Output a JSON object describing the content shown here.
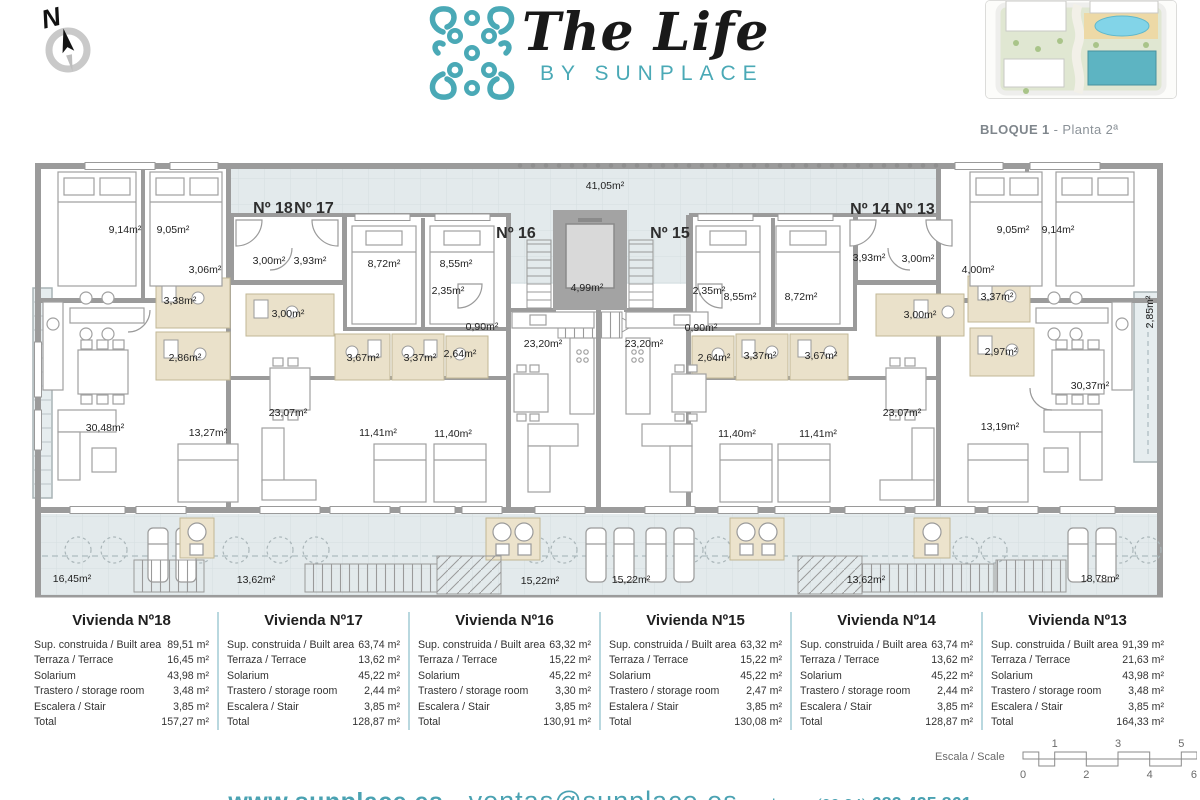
{
  "header": {
    "compass_letter": "N",
    "logo_title": "The Life",
    "logo_subtitle": "BY SUNPLACE",
    "siteplan_caption_bold": "BLOQUE 1",
    "siteplan_caption_rest": " - Planta 2ª"
  },
  "colors": {
    "brand_teal": "#4aa9b6",
    "wall_gray": "#9b9b9b",
    "terrace_fill": "#e3eaec",
    "bathroom_tan": "#eae1ca"
  },
  "plan": {
    "unit_labels": [
      {
        "t": "Nº 18",
        "x": 243,
        "y": 57
      },
      {
        "t": "Nº 17",
        "x": 284,
        "y": 57
      },
      {
        "t": "Nº 16",
        "x": 486,
        "y": 82
      },
      {
        "t": "Nº 15",
        "x": 640,
        "y": 82
      },
      {
        "t": "Nº 14",
        "x": 840,
        "y": 58
      },
      {
        "t": "Nº 13",
        "x": 885,
        "y": 58
      }
    ],
    "area_labels": [
      {
        "t": "41,05m²",
        "x": 575,
        "y": 34
      },
      {
        "t": "9,14m²",
        "x": 95,
        "y": 78
      },
      {
        "t": "9,05m²",
        "x": 143,
        "y": 78
      },
      {
        "t": "3,06m²",
        "x": 175,
        "y": 118
      },
      {
        "t": "3,00m²",
        "x": 239,
        "y": 109
      },
      {
        "t": "3,93m²",
        "x": 280,
        "y": 109
      },
      {
        "t": "8,72m²",
        "x": 354,
        "y": 112
      },
      {
        "t": "8,55m²",
        "x": 426,
        "y": 112
      },
      {
        "t": "2,35m²",
        "x": 418,
        "y": 139
      },
      {
        "t": "4,99m²",
        "x": 557,
        "y": 136
      },
      {
        "t": "2,35m²",
        "x": 679,
        "y": 139
      },
      {
        "t": "0,90m²",
        "x": 452,
        "y": 175
      },
      {
        "t": "0,90m²",
        "x": 671,
        "y": 176
      },
      {
        "t": "23,20m²",
        "x": 513,
        "y": 192
      },
      {
        "t": "23,20m²",
        "x": 614,
        "y": 192
      },
      {
        "t": "3,38m²",
        "x": 150,
        "y": 149
      },
      {
        "t": "3,00m²",
        "x": 258,
        "y": 162
      },
      {
        "t": "2,86m²",
        "x": 155,
        "y": 206
      },
      {
        "t": "3,67m²",
        "x": 333,
        "y": 206
      },
      {
        "t": "3,37m²",
        "x": 390,
        "y": 206
      },
      {
        "t": "2,64m²",
        "x": 430,
        "y": 202
      },
      {
        "t": "2,64m²",
        "x": 684,
        "y": 206
      },
      {
        "t": "3,37m²",
        "x": 730,
        "y": 204
      },
      {
        "t": "3,67m²",
        "x": 791,
        "y": 204
      },
      {
        "t": "8,55m²",
        "x": 710,
        "y": 145
      },
      {
        "t": "8,72m²",
        "x": 771,
        "y": 145
      },
      {
        "t": "3,93m²",
        "x": 839,
        "y": 106
      },
      {
        "t": "3,00m²",
        "x": 888,
        "y": 107
      },
      {
        "t": "3,00m²",
        "x": 890,
        "y": 163
      },
      {
        "t": "9,05m²",
        "x": 983,
        "y": 78
      },
      {
        "t": "9,14m²",
        "x": 1028,
        "y": 78
      },
      {
        "t": "4,00m²",
        "x": 948,
        "y": 118
      },
      {
        "t": "3,37m²",
        "x": 967,
        "y": 145
      },
      {
        "t": "2,97m²",
        "x": 971,
        "y": 200
      },
      {
        "t": "30,37m²",
        "x": 1060,
        "y": 234
      },
      {
        "t": "13,19m²",
        "x": 970,
        "y": 275
      },
      {
        "t": "23,07m²",
        "x": 872,
        "y": 261
      },
      {
        "t": "11,40m²",
        "x": 707,
        "y": 282
      },
      {
        "t": "11,41m²",
        "x": 788,
        "y": 282
      },
      {
        "t": "11,41m²",
        "x": 348,
        "y": 281
      },
      {
        "t": "11,40m²",
        "x": 423,
        "y": 282
      },
      {
        "t": "23,07m²",
        "x": 258,
        "y": 261
      },
      {
        "t": "13,27m²",
        "x": 178,
        "y": 281
      },
      {
        "t": "30,48m²",
        "x": 75,
        "y": 276
      },
      {
        "t": "2,85m²",
        "x": 1120,
        "y": 160,
        "r": -90
      },
      {
        "t": "16,45m²",
        "x": 42,
        "y": 427
      },
      {
        "t": "13,62m²",
        "x": 226,
        "y": 428
      },
      {
        "t": "15,22m²",
        "x": 510,
        "y": 429
      },
      {
        "t": "15,22m²",
        "x": 601,
        "y": 428
      },
      {
        "t": "13,62m²",
        "x": 836,
        "y": 428
      },
      {
        "t": "18,78m²",
        "x": 1070,
        "y": 427
      }
    ]
  },
  "viviendas": [
    {
      "title": "Vivienda Nº18",
      "rows": [
        [
          "Sup. construida / Built area",
          "89,51 m²"
        ],
        [
          "Terraza / Terrace",
          "16,45 m²"
        ],
        [
          "Solarium",
          "43,98 m²"
        ],
        [
          "Trastero / storage room",
          "3,48 m²"
        ],
        [
          "Escalera / Stair",
          "3,85 m²"
        ],
        [
          "Total",
          "157,27 m²"
        ]
      ]
    },
    {
      "title": "Vivienda Nº17",
      "rows": [
        [
          "Sup. construida / Built area",
          "63,74 m²"
        ],
        [
          "Terraza / Terrace",
          "13,62 m²"
        ],
        [
          "Solarium",
          "45,22 m²"
        ],
        [
          "Trastero / storage room",
          "2,44 m²"
        ],
        [
          "Escalera / Stair",
          "3,85 m²"
        ],
        [
          "Total",
          "128,87 m²"
        ]
      ]
    },
    {
      "title": "Vivienda Nº16",
      "rows": [
        [
          "Sup. construida / Built area",
          "63,32 m²"
        ],
        [
          "Terraza / Terrace",
          "15,22 m²"
        ],
        [
          "Solarium",
          "45,22 m²"
        ],
        [
          "Trastero / storage room",
          "3,30 m²"
        ],
        [
          "Escalera / Stair",
          "3,85 m²"
        ],
        [
          "Total",
          "130,91 m²"
        ]
      ]
    },
    {
      "title": "Vivienda Nº15",
      "rows": [
        [
          "Sup. construida / Built area",
          "63,32 m²"
        ],
        [
          "Terraza / Terrace",
          "15,22 m²"
        ],
        [
          "Solarium",
          "45,22 m²"
        ],
        [
          "Trastero / storage room",
          "2,47 m²"
        ],
        [
          "Estalera / Stair",
          "3,85 m²"
        ],
        [
          "Total",
          "130,08 m²"
        ]
      ]
    },
    {
      "title": "Vivienda Nº14",
      "rows": [
        [
          "Sup. construida / Built area",
          "63,74 m²"
        ],
        [
          "Terraza / Terrace",
          "13,62 m²"
        ],
        [
          "Solarium",
          "45,22 m²"
        ],
        [
          "Trastero / storage room",
          "2,44 m²"
        ],
        [
          "Escalera / Stair",
          "3,85 m²"
        ],
        [
          "Total",
          "128,87 m²"
        ]
      ]
    },
    {
      "title": "Vivienda Nº13",
      "rows": [
        [
          "Sup. construida / Built area",
          "91,39 m²"
        ],
        [
          "Terraza / Terrace",
          "21,63 m²"
        ],
        [
          "Solarium",
          "43,98 m²"
        ],
        [
          "Trastero / storage room",
          "3,48 m²"
        ],
        [
          "Escalera / Stair",
          "3,85 m²"
        ],
        [
          "Total",
          "164,33 m²"
        ]
      ]
    }
  ],
  "scale": {
    "label": "Escala / Scale",
    "top_ticks": [
      "1",
      "3",
      "5"
    ],
    "bottom_ticks": [
      "0",
      "2",
      "4",
      "6"
    ]
  },
  "footer": {
    "website": "www.sunplace.es",
    "sep1": "-",
    "email": "ventas@sunplace.es",
    "sep2": "-",
    "phone_label": "phone: (00 34)",
    "phone_number": "682 425 861"
  }
}
